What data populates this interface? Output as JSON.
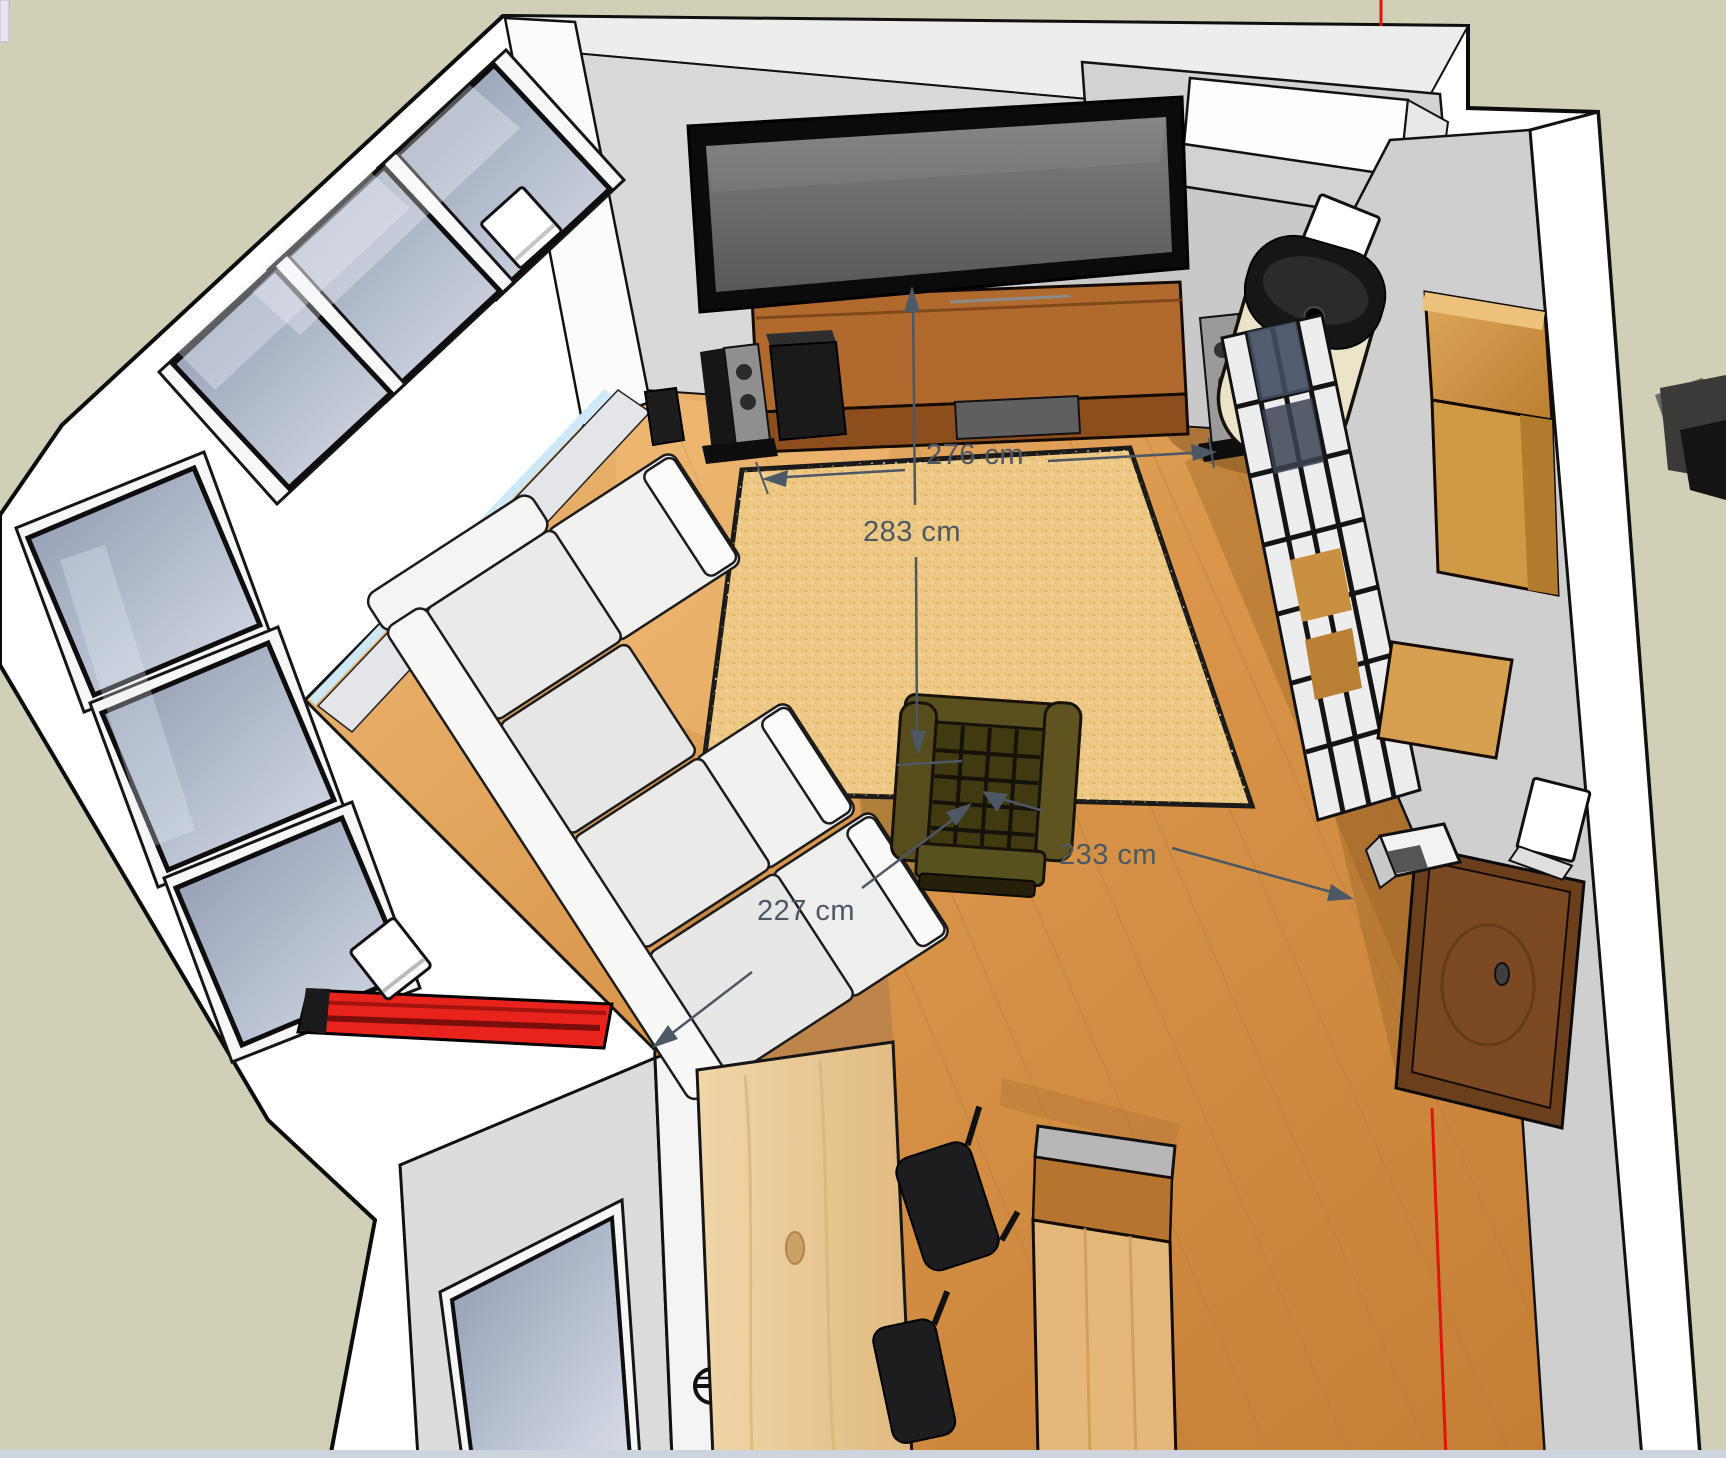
{
  "canvas": {
    "width": 1726,
    "height": 1458
  },
  "scene": {
    "annotations": {
      "dim_276": {
        "label": "276 cm"
      },
      "dim_283": {
        "label": "283 cm"
      },
      "dim_233": {
        "label": "233 cm"
      },
      "dim_227": {
        "label": "227 cm"
      }
    },
    "colors": {
      "background": "#d1cfb5",
      "wall_gray": "#cfcfcf",
      "wall_inner": "#d9d9d9",
      "floor_wood": "#d99549",
      "rug": "#eec985",
      "tv_bezel": "#0b0b0b",
      "tv_screen": "#6f6f6f",
      "console_wood": "#8d4e1d",
      "stove_body": "#ece4c8",
      "stove_top": "#161616",
      "flame": "#e89a35",
      "armchair_seat": "#403a10",
      "armchair_frame": "#57511d",
      "sofa": "#eaeae8",
      "window_glass": "#aab3c4",
      "sill_blue": "#cde9f7",
      "accent_red": "#e8231c",
      "pine_table": "#ecd2a4",
      "island_wood": "#b5752f",
      "sideboard_dark": "#7b4a22",
      "shelf_wood": "#cf9a46",
      "dimension": "#4c5864",
      "bottom_strip": "#ccd4de"
    }
  }
}
